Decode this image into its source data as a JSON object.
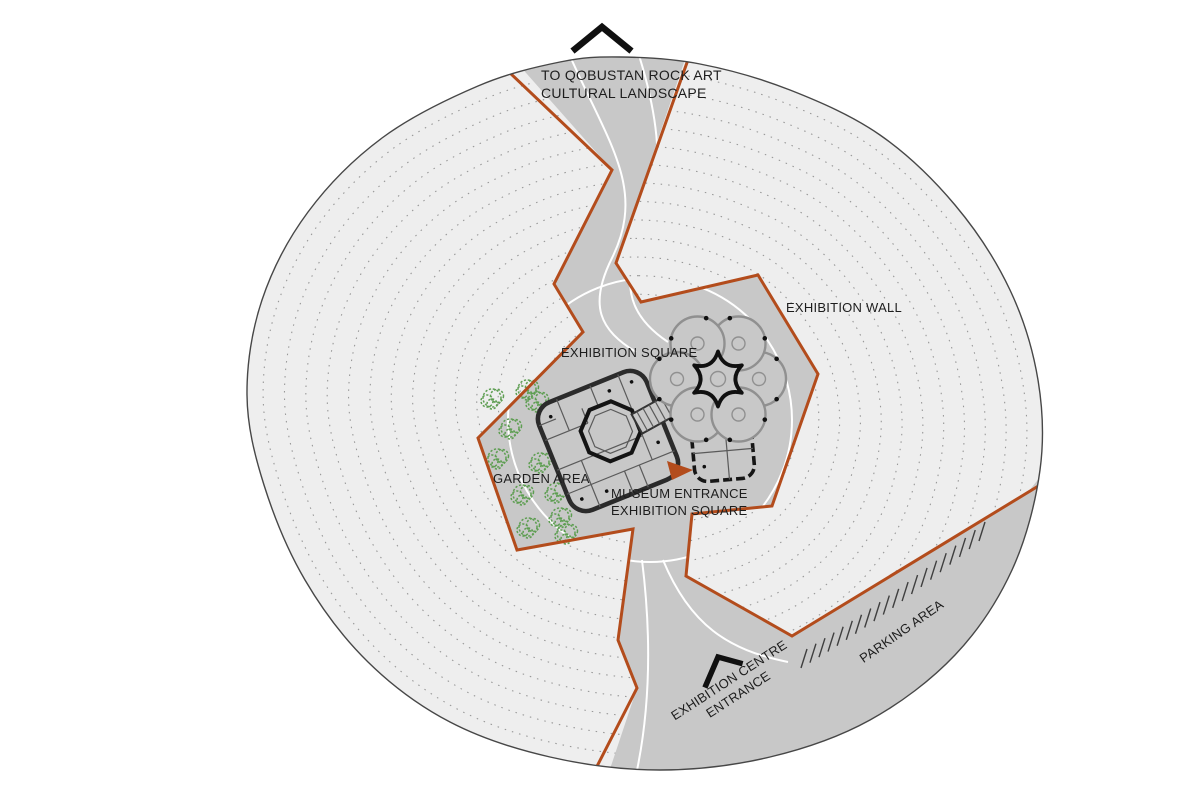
{
  "title": "Qobustan exhibition centre site plan",
  "colors": {
    "accent_orange": "#b34c1c",
    "site_fill": "#eeeeee",
    "road_fill": "#c8c8c8",
    "contour_gray": "#989898",
    "tree_green": "#5e9e52",
    "label_color": "#1d1d1d"
  },
  "labels": {
    "to_qobustan_line1": "TO QOBUSTAN ROCK ART",
    "to_qobustan_line2": "CULTURAL LANDSCAPE",
    "exhibition_wall": "EXHIBITION WALL",
    "exhibition_square": "EXHIBITION SQUARE",
    "garden_area": "GARDEN AREA",
    "museum_entrance_line1": "MUSEUM ENTRANCE",
    "museum_entrance_line2": "EXHIBITION SQUARE",
    "exhibition_centre_line1": "EXHIBITION CENTRE",
    "exhibition_centre_line2": "ENTRANCE",
    "parking_area": "PARKING AREA"
  },
  "markers": {
    "north_marker": "chevron-up",
    "entrance_marker": "chevron-rotated",
    "museum_entrance_pointer": "orange-triangle"
  }
}
